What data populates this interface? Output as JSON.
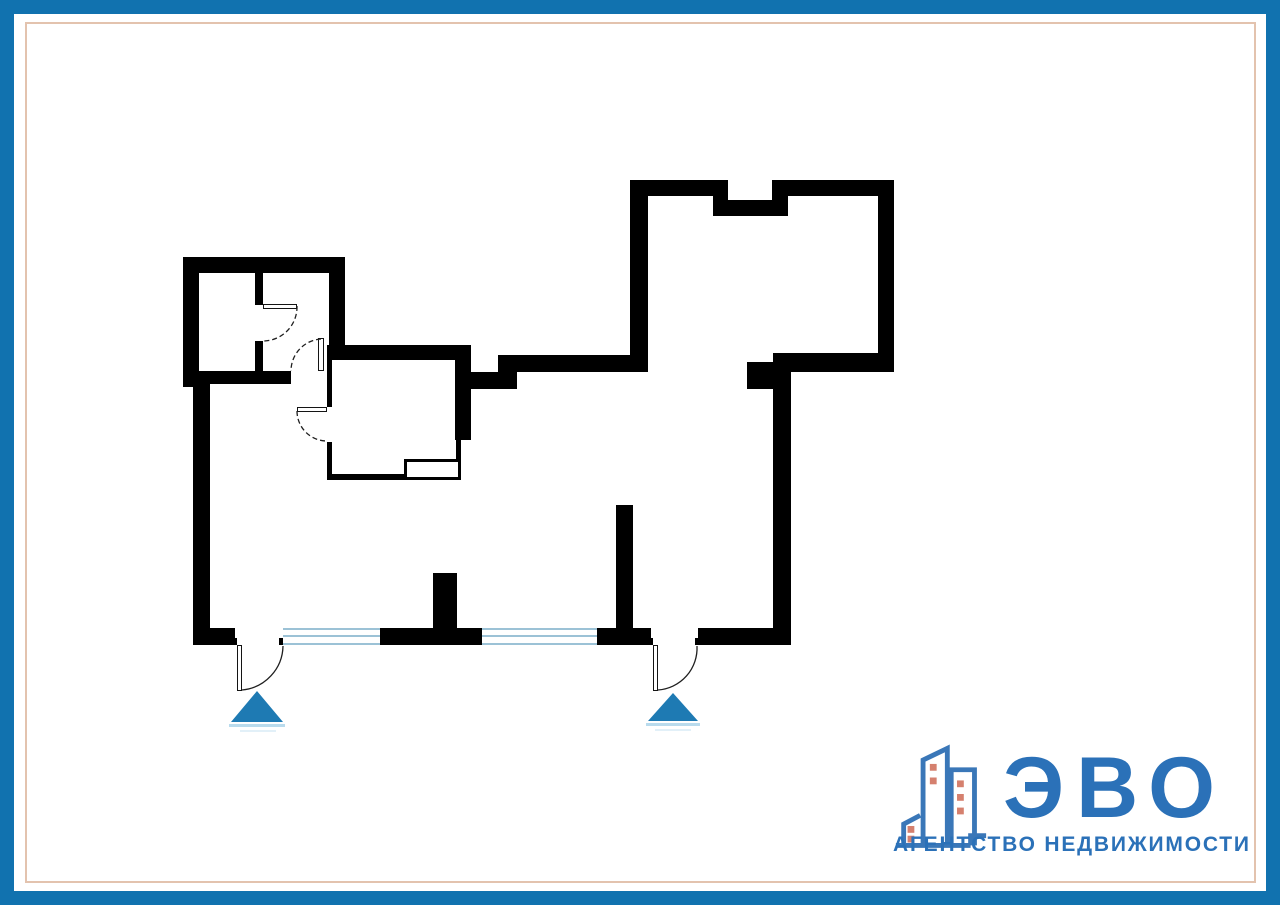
{
  "page": {
    "frame_color": "#1172af",
    "inner_line_color": "#e3c3ae",
    "background": "#ffffff"
  },
  "plan": {
    "wall_color": "#000000",
    "window_line_color": "#9cc2d6",
    "arc_color": "#1f1f1f",
    "walls": [
      [
        183,
        257,
        16,
        130
      ],
      [
        183,
        257,
        162,
        16
      ],
      [
        329,
        257,
        16,
        103
      ],
      [
        183,
        371,
        108,
        13
      ],
      [
        255,
        273,
        8,
        32
      ],
      [
        255,
        341,
        8,
        30
      ],
      [
        327,
        345,
        144,
        15
      ],
      [
        327,
        360,
        5,
        47
      ],
      [
        327,
        442,
        5,
        38
      ],
      [
        455,
        345,
        16,
        95
      ],
      [
        456,
        440,
        5,
        40
      ],
      [
        327,
        474,
        134,
        6
      ],
      [
        471,
        372,
        46,
        17
      ],
      [
        498,
        355,
        19,
        34
      ],
      [
        498,
        355,
        150,
        17
      ],
      [
        630,
        180,
        18,
        192
      ],
      [
        630,
        180,
        83,
        16
      ],
      [
        713,
        180,
        15,
        36
      ],
      [
        772,
        180,
        16,
        36
      ],
      [
        713,
        200,
        75,
        16
      ],
      [
        788,
        180,
        106,
        16
      ],
      [
        878,
        180,
        16,
        192
      ],
      [
        773,
        353,
        121,
        19
      ],
      [
        747,
        362,
        36,
        27
      ],
      [
        773,
        353,
        18,
        292
      ],
      [
        193,
        383,
        17,
        262
      ],
      [
        193,
        628,
        42,
        17
      ],
      [
        380,
        628,
        102,
        17
      ],
      [
        597,
        628,
        54,
        17
      ],
      [
        698,
        628,
        93,
        17
      ],
      [
        433,
        573,
        24,
        55
      ],
      [
        616,
        505,
        17,
        123
      ]
    ],
    "jambs": [
      [
        233,
        638,
        4,
        7
      ],
      [
        279,
        638,
        4,
        7
      ],
      [
        649,
        638,
        4,
        7
      ],
      [
        695,
        638,
        4,
        7
      ]
    ],
    "duct": [
      404,
      459,
      57,
      21
    ],
    "windows": [
      [
        283,
        628,
        97,
        17
      ],
      [
        482,
        628,
        115,
        17
      ]
    ],
    "door_leaves": [
      [
        237,
        645,
        5,
        46
      ],
      [
        653,
        645,
        5,
        46
      ],
      [
        263,
        304,
        34,
        5
      ],
      [
        318,
        338,
        6,
        33
      ],
      [
        297,
        407,
        30,
        5
      ]
    ],
    "door_arcs": [
      {
        "d": "M 242 690 A 45 45 0 0 0 283 646",
        "style": "solid"
      },
      {
        "d": "M 658 690 A 42 42 0 0 0 697 646",
        "style": "solid"
      },
      {
        "d": "M 297 306 A 34 34 0 0 1 263 341",
        "style": "dashed"
      },
      {
        "d": "M 321 339 A 32 32 0 0 0 291 371",
        "style": "dashed"
      },
      {
        "d": "M 297 411 A 30 30 0 0 0 327 441",
        "style": "dashed"
      }
    ],
    "triangle_color": "#1e7ab3",
    "triangle_underline_color": "#b9dbed",
    "triangle_underline2_color": "#e2f0f8",
    "entrance_triangles": [
      {
        "points": "231,722 283,722 257,691",
        "underline": [
          229,
          724,
          56,
          3
        ],
        "underline2": [
          240,
          730,
          36,
          2
        ]
      },
      {
        "points": "648,721 698,721 673,693",
        "underline": [
          646,
          723,
          54,
          3
        ],
        "underline2": [
          655,
          729,
          36,
          2
        ]
      }
    ]
  },
  "logo": {
    "title": "ЭВО",
    "subtitle": "АГЕНТСТВО НЕДВИЖИМОСТИ",
    "text_color": "#2b71b8",
    "icon_stroke_color": "#3a77b8",
    "icon_window_color": "#d5806e",
    "icon_paths": [
      "M3 109 H80 M80 109 V99 H96",
      "M11 109 V87 L28 78",
      "M31 109 V21 L56 9 V109",
      "M60 109 V31 H84 V109"
    ],
    "icon_windows": [
      [
        15,
        89
      ],
      [
        15,
        99
      ],
      [
        38,
        25
      ],
      [
        38,
        39
      ],
      [
        66,
        42
      ],
      [
        66,
        56
      ],
      [
        66,
        70
      ]
    ]
  }
}
